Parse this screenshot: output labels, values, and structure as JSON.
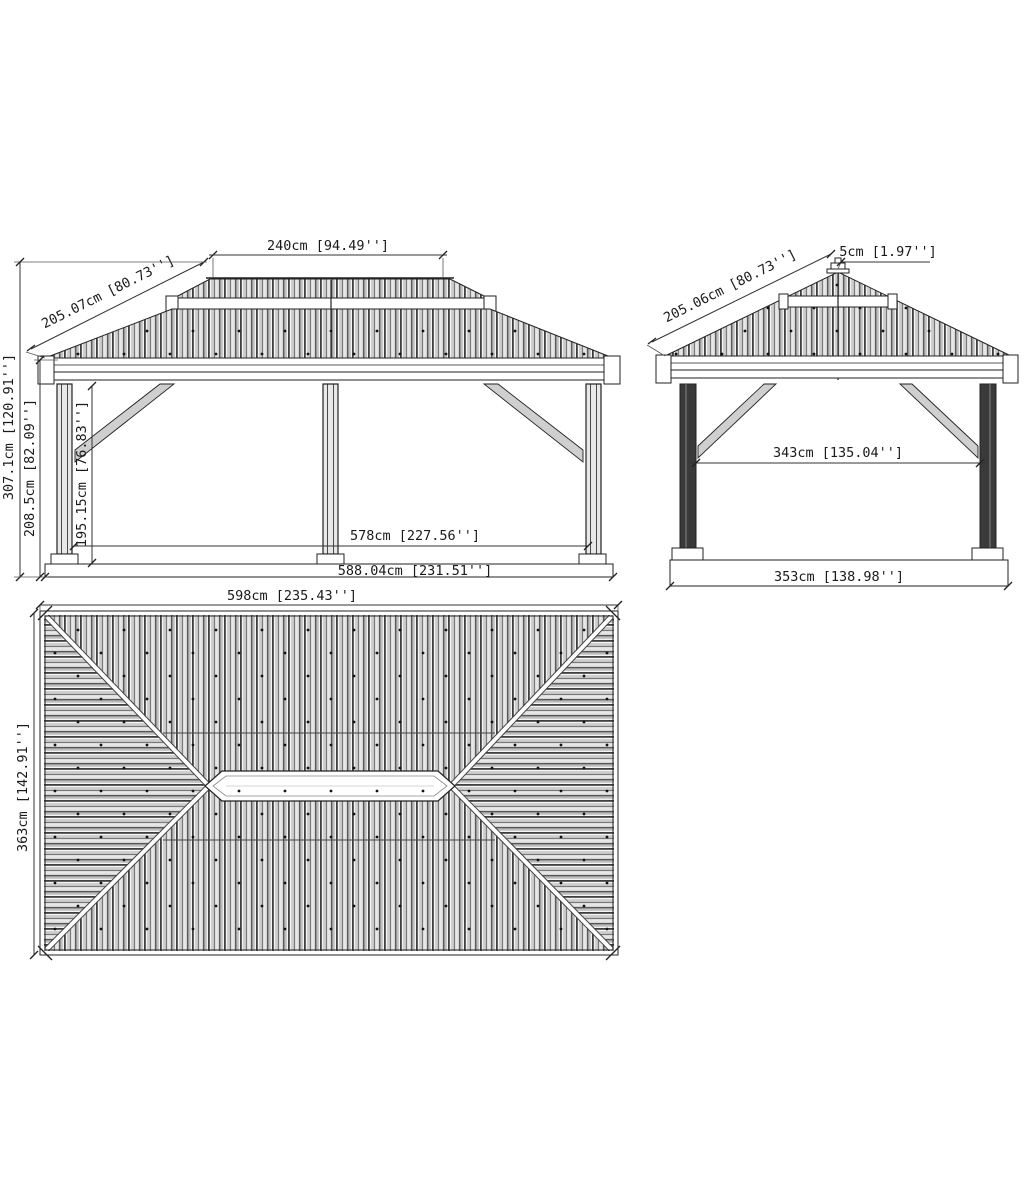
{
  "drawing": {
    "kind": "gazebo-dimension-drawing",
    "colors": {
      "line": "#1a1a1a",
      "background": "#ffffff"
    },
    "views": {
      "front_elevation": {
        "dims": {
          "upper_roof_width": "240cm [94.49'']",
          "roof_slope_length": "205.07cm [80.73'']",
          "total_height": "307.1cm [120.91'']",
          "eave_height": "208.5cm [82.09'']",
          "clearance_height": "195.15cm [76.83'']",
          "post_span": "578cm [227.56'']",
          "base_span": "588.04cm [231.51'']"
        }
      },
      "side_elevation": {
        "dims": {
          "finial_height": "5cm [1.97'']",
          "roof_slope_length": "205.06cm [80.73'']",
          "post_span": "343cm [135.04'']",
          "base_span": "353cm [138.98'']"
        }
      },
      "roof_plan": {
        "dims": {
          "roof_width": "598cm [235.43'']",
          "roof_depth": "363cm [142.91'']"
        }
      }
    }
  }
}
